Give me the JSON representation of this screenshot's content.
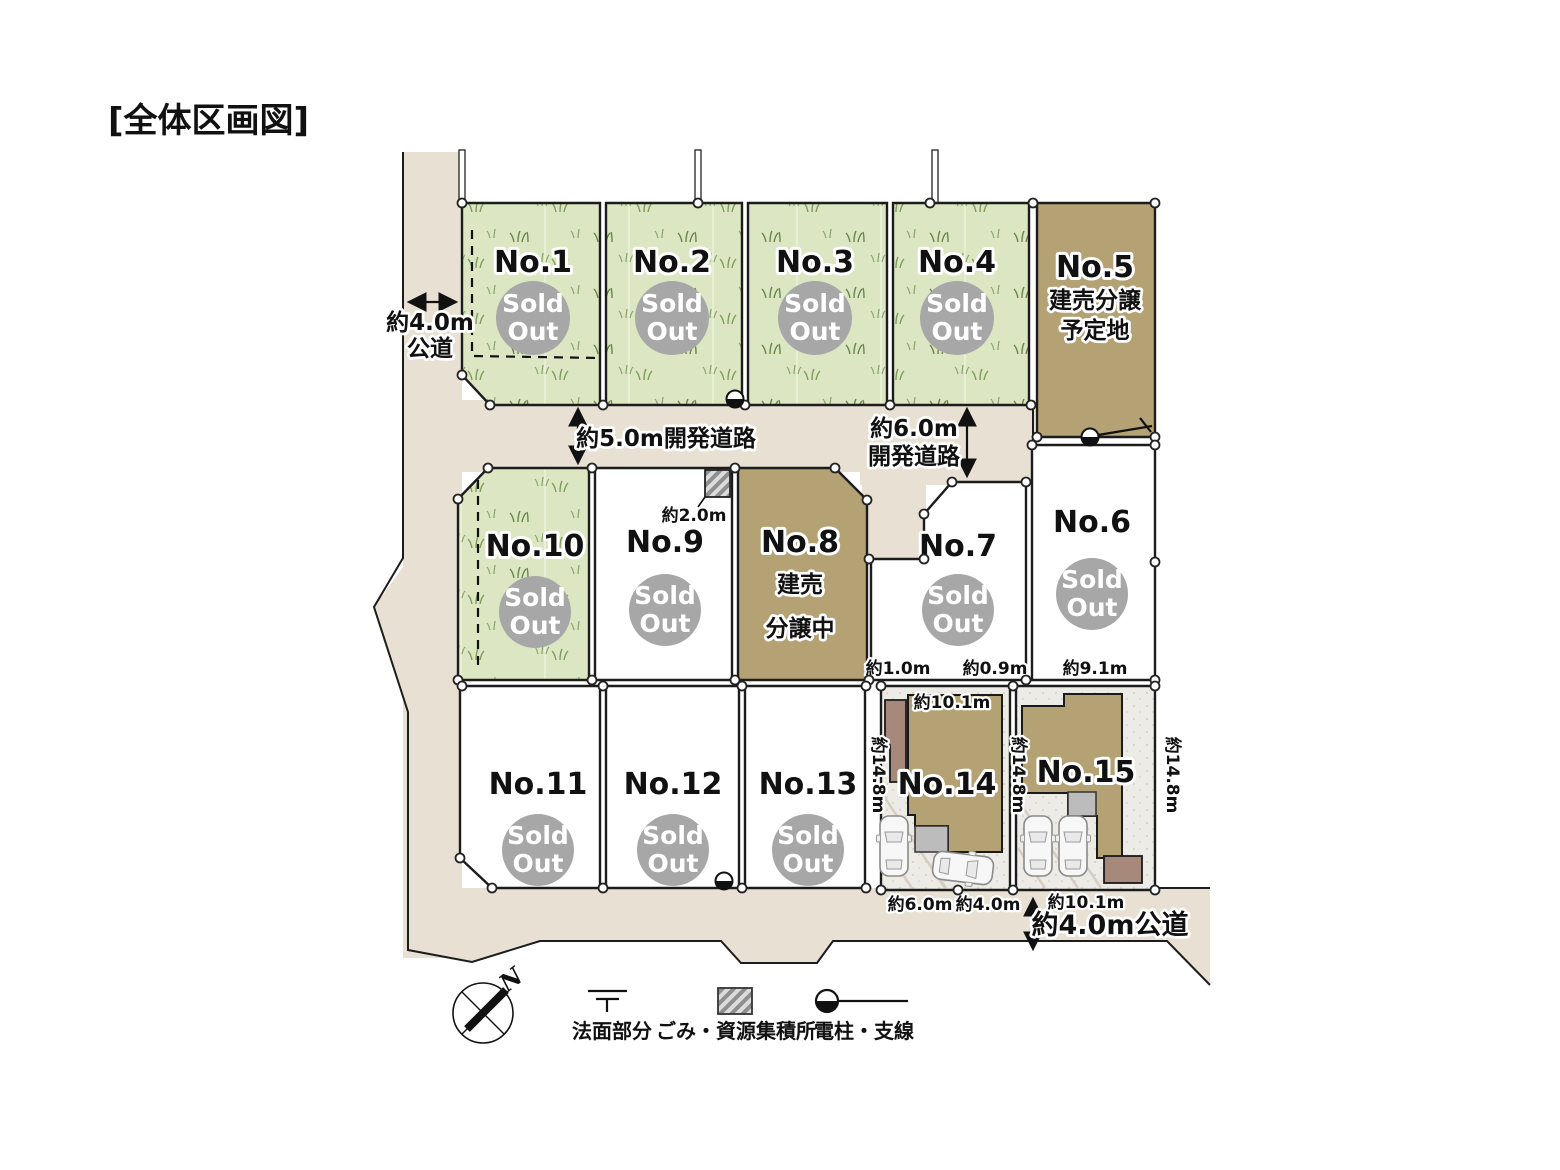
{
  "title": "[全体区画図]",
  "badge": {
    "line1": "Sold",
    "line2": "Out"
  },
  "lots": {
    "no1": {
      "label": "No.1"
    },
    "no2": {
      "label": "No.2"
    },
    "no3": {
      "label": "No.3"
    },
    "no4": {
      "label": "No.4"
    },
    "no5": {
      "label": "No.5",
      "note1": "建売分譲",
      "note2": "予定地"
    },
    "no6": {
      "label": "No.6"
    },
    "no7": {
      "label": "No.7"
    },
    "no8": {
      "label": "No.8",
      "note1": "建売",
      "note2": "分譲中"
    },
    "no9": {
      "label": "No.9"
    },
    "no10": {
      "label": "No.10"
    },
    "no11": {
      "label": "No.11"
    },
    "no12": {
      "label": "No.12"
    },
    "no13": {
      "label": "No.13"
    },
    "no14": {
      "label": "No.14"
    },
    "no15": {
      "label": "No.15"
    }
  },
  "road_labels": {
    "west_width": "約4.0m",
    "west_type": "公道",
    "mid": "約5.0m開発道路",
    "east_line1": "約6.0m",
    "east_line2": "開発道路",
    "south": "約4.0m公道"
  },
  "dimensions": {
    "garbage_width": "約2.0m",
    "lot7_left": "約1.0m",
    "lot7_right": "約0.9m",
    "lot6_width": "約9.1m",
    "lot14_width": "約10.1m",
    "depth_left": "約14.8m",
    "depth_mid": "約14.8m",
    "depth_right": "約14.8m",
    "south_w1": "約6.0m",
    "south_w2": "約4.0m",
    "south_w3": "約10.1m"
  },
  "legend": {
    "slope": "法面部分",
    "garbage": "ごみ・資源集積所",
    "pole": "電柱・支線"
  },
  "compass": {
    "north": "N"
  },
  "colors": {
    "road": "#e8e1d3",
    "grass": "#dce6c2",
    "brown_lot": "#b4a274",
    "sold_circle": "#a7a7a7",
    "outline": "#1c1c1c"
  }
}
